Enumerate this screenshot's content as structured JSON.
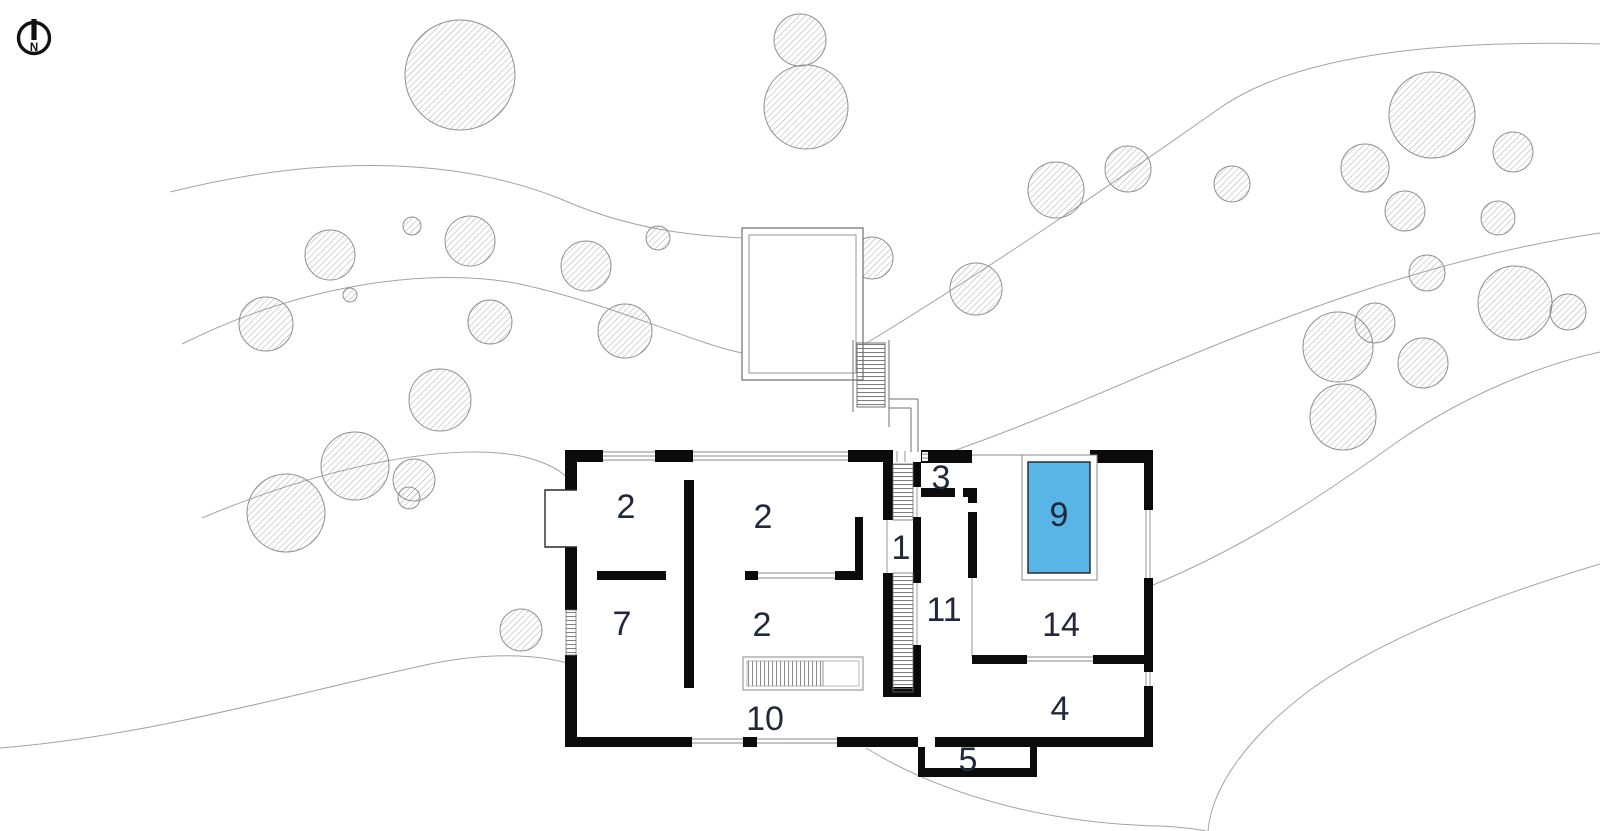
{
  "meta": {
    "drawing_type": "architectural site / floor plan"
  },
  "north": {
    "label": "N"
  },
  "pool": {
    "label": "9",
    "color": "#5ab5e7"
  },
  "rooms": [
    {
      "id": "room-2-upper-left",
      "label": "2"
    },
    {
      "id": "room-2-upper-middle",
      "label": "2"
    },
    {
      "id": "room-7",
      "label": "7"
    },
    {
      "id": "room-2-lower-middle",
      "label": "2"
    },
    {
      "id": "room-10",
      "label": "10"
    },
    {
      "id": "room-1-stair-hall",
      "label": "1"
    },
    {
      "id": "room-3",
      "label": "3"
    },
    {
      "id": "room-11",
      "label": "11"
    },
    {
      "id": "room-9-pool",
      "label": "9"
    },
    {
      "id": "room-14-pool-terrace",
      "label": "14"
    },
    {
      "id": "room-4",
      "label": "4"
    },
    {
      "id": "room-5-entry-step",
      "label": "5"
    }
  ]
}
